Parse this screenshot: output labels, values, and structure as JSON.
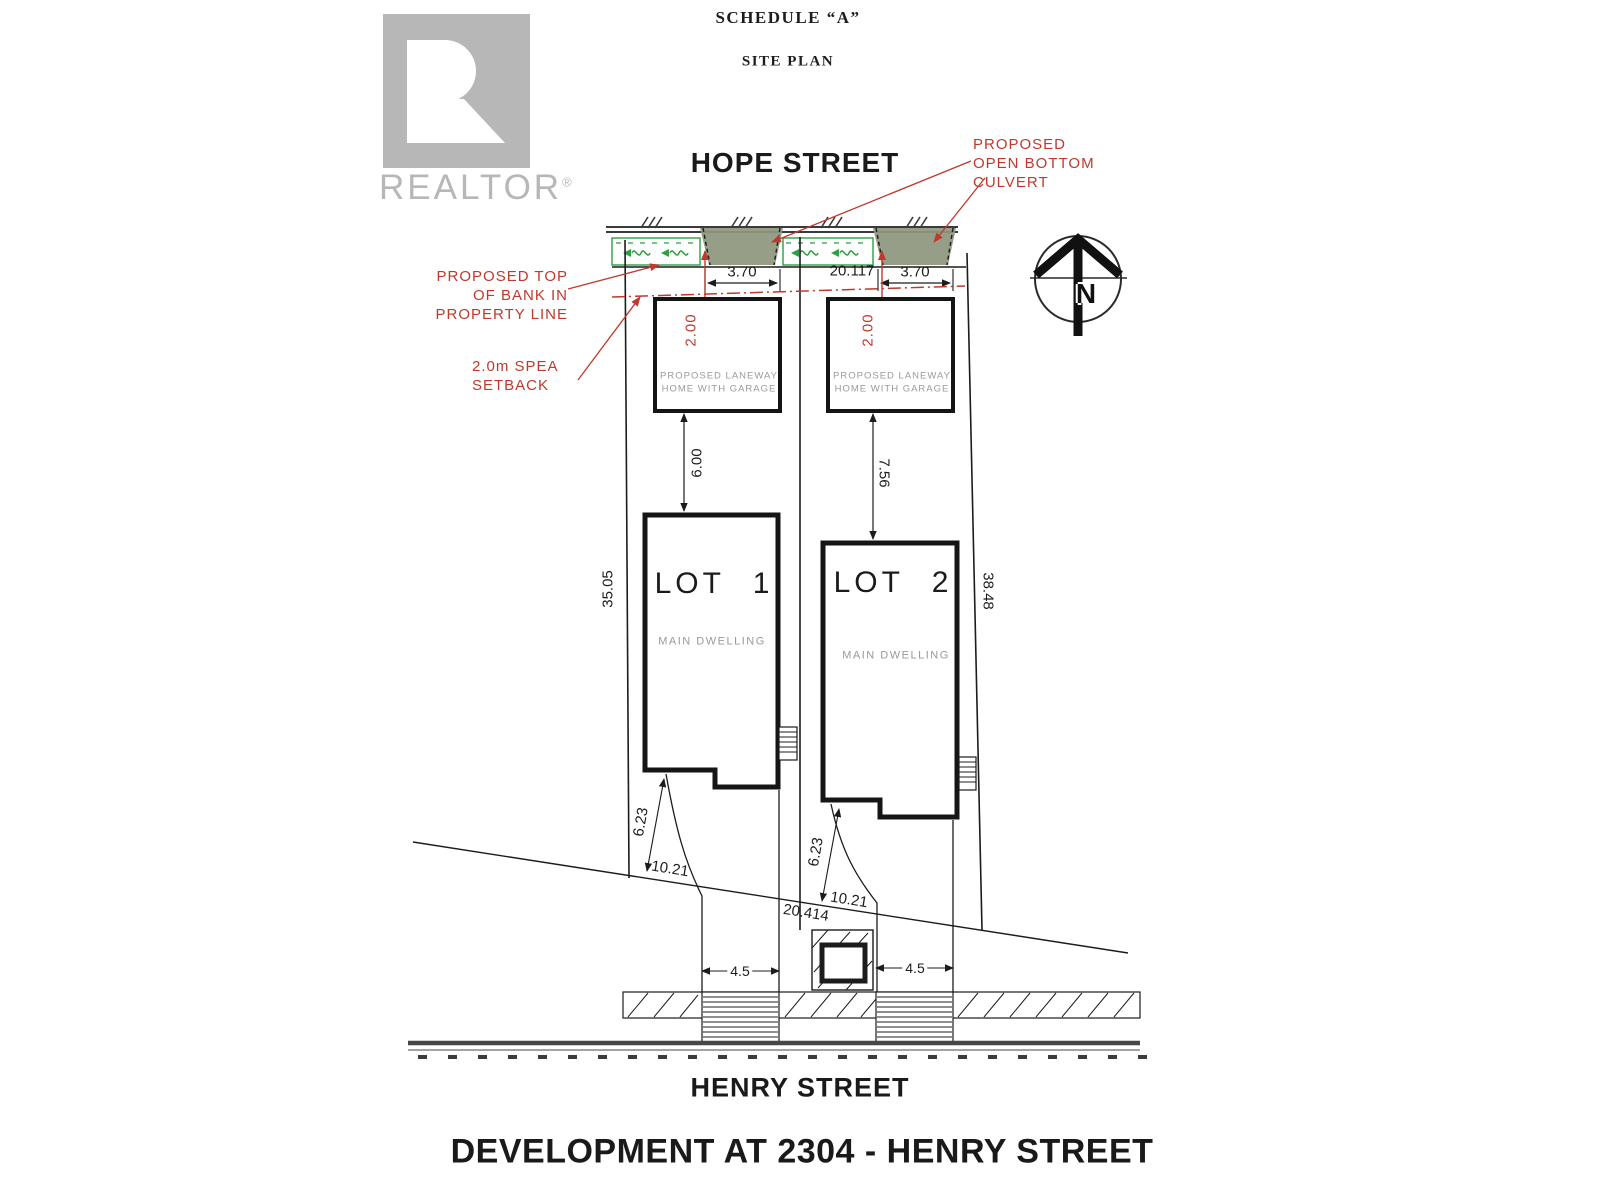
{
  "page": {
    "schedule_title": "SCHEDULE “A”",
    "plan_title": "SITE PLAN",
    "development_title": "DEVELOPMENT AT 2304 - HENRY STREET"
  },
  "watermark": {
    "brand": "REALTOR",
    "registered": "®"
  },
  "streets": {
    "top": "HOPE STREET",
    "bottom": "HENRY STREET"
  },
  "compass": {
    "north": "N"
  },
  "annotations": {
    "culvert": {
      "l1": "PROPOSED",
      "l2": "OPEN BOTTOM",
      "l3": "CULVERT"
    },
    "bank": {
      "l1": "PROPOSED TOP",
      "l2": "OF BANK IN",
      "l3": "PROPERTY LINE"
    },
    "spea": {
      "l1": "2.0m SPEA",
      "l2": "SETBACK"
    }
  },
  "site": {
    "frontage": "20.117",
    "rear_width": "20.414"
  },
  "lot1": {
    "name": "LOT 1",
    "dwelling": "MAIN DWELLING",
    "laneway": {
      "l1": "PROPOSED LANEWAY",
      "l2": "HOME WITH GARAGE"
    },
    "dims": {
      "culvert_width": "3.70",
      "spea_setback": "2.00",
      "laneway_gap": "6.00",
      "depth": "35.05",
      "rear_side": "6.23",
      "rear_front": "10.21",
      "driveway": "4.5"
    }
  },
  "lot2": {
    "name": "LOT 2",
    "dwelling": "MAIN DWELLING",
    "laneway": {
      "l1": "PROPOSED LANEWAY",
      "l2": "HOME WITH GARAGE"
    },
    "dims": {
      "culvert_width": "3.70",
      "spea_setback": "2.00",
      "laneway_gap": "7.56",
      "depth": "38.48",
      "rear_side": "6.23",
      "rear_front": "10.21",
      "driveway": "4.5"
    }
  },
  "colors": {
    "annotation_red": "#bf392c",
    "vegetation_green": "#2f9e41",
    "culvert_fill": "#8f977f",
    "watermark_gray": "#b7b7b7"
  }
}
